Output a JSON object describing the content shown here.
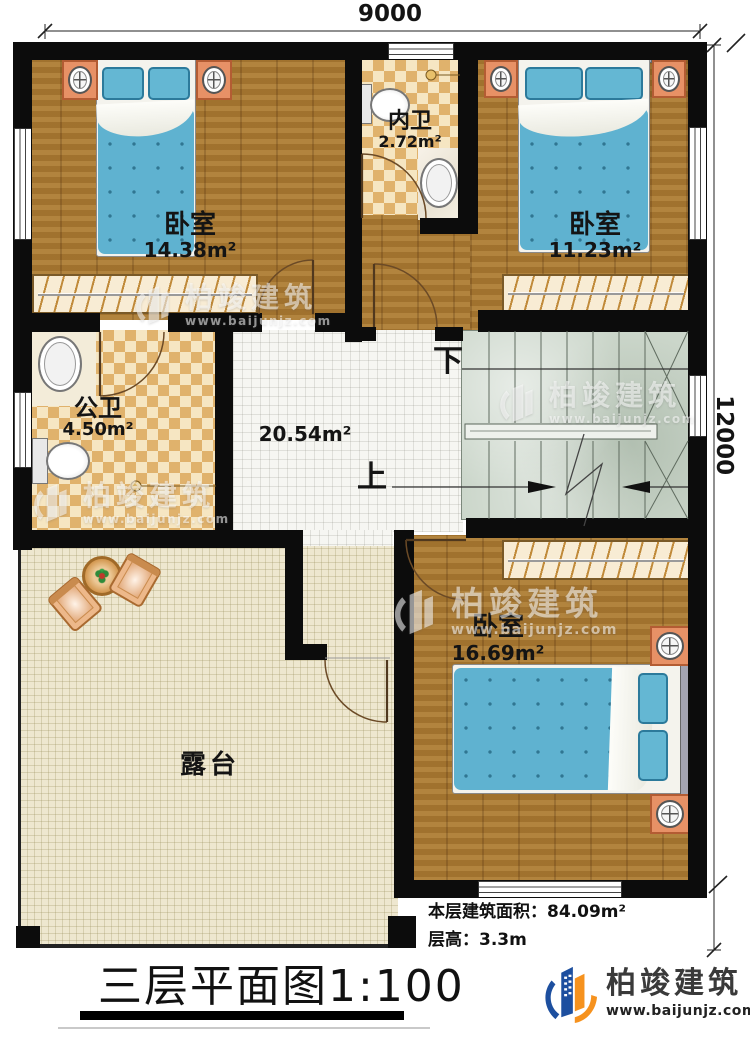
{
  "dimensions": {
    "width_top": "9000",
    "height_right": "12000"
  },
  "title": "三层平面图1:100",
  "info": {
    "area_line": "本层建筑面积：84.09m²",
    "height_line": "层高：3.3m"
  },
  "rooms": {
    "bedroom_top_left": {
      "name": "卧室",
      "area": "14.38m²"
    },
    "inner_bath": {
      "name": "内卫",
      "area": "2.72m²"
    },
    "bedroom_top_right": {
      "name": "卧室",
      "area": "11.23m²"
    },
    "public_bath": {
      "name": "公卫",
      "area": "4.50m²"
    },
    "hall": {
      "area": "20.54m²"
    },
    "bedroom_bottom_right": {
      "name": "卧室",
      "area": "16.69m²"
    },
    "terrace": {
      "name": "露台"
    }
  },
  "stairs": {
    "up_label": "上",
    "down_label": "下"
  },
  "brand": {
    "name": "柏竣建筑",
    "url": "www.baijunjz.com"
  },
  "watermark": {
    "name": "柏竣建筑",
    "url": "www.baijunjz.com"
  },
  "colors": {
    "wall": "#0c0c0c",
    "wood_floor": "#a97932",
    "checker_tile": "#e0b26c",
    "stair": "#cbd6ca",
    "bed_blue": "#5fb2d0",
    "terrace_floor": "#eee7cf",
    "brand_blue": "#1d4f9f",
    "brand_orange": "#f6921e"
  }
}
